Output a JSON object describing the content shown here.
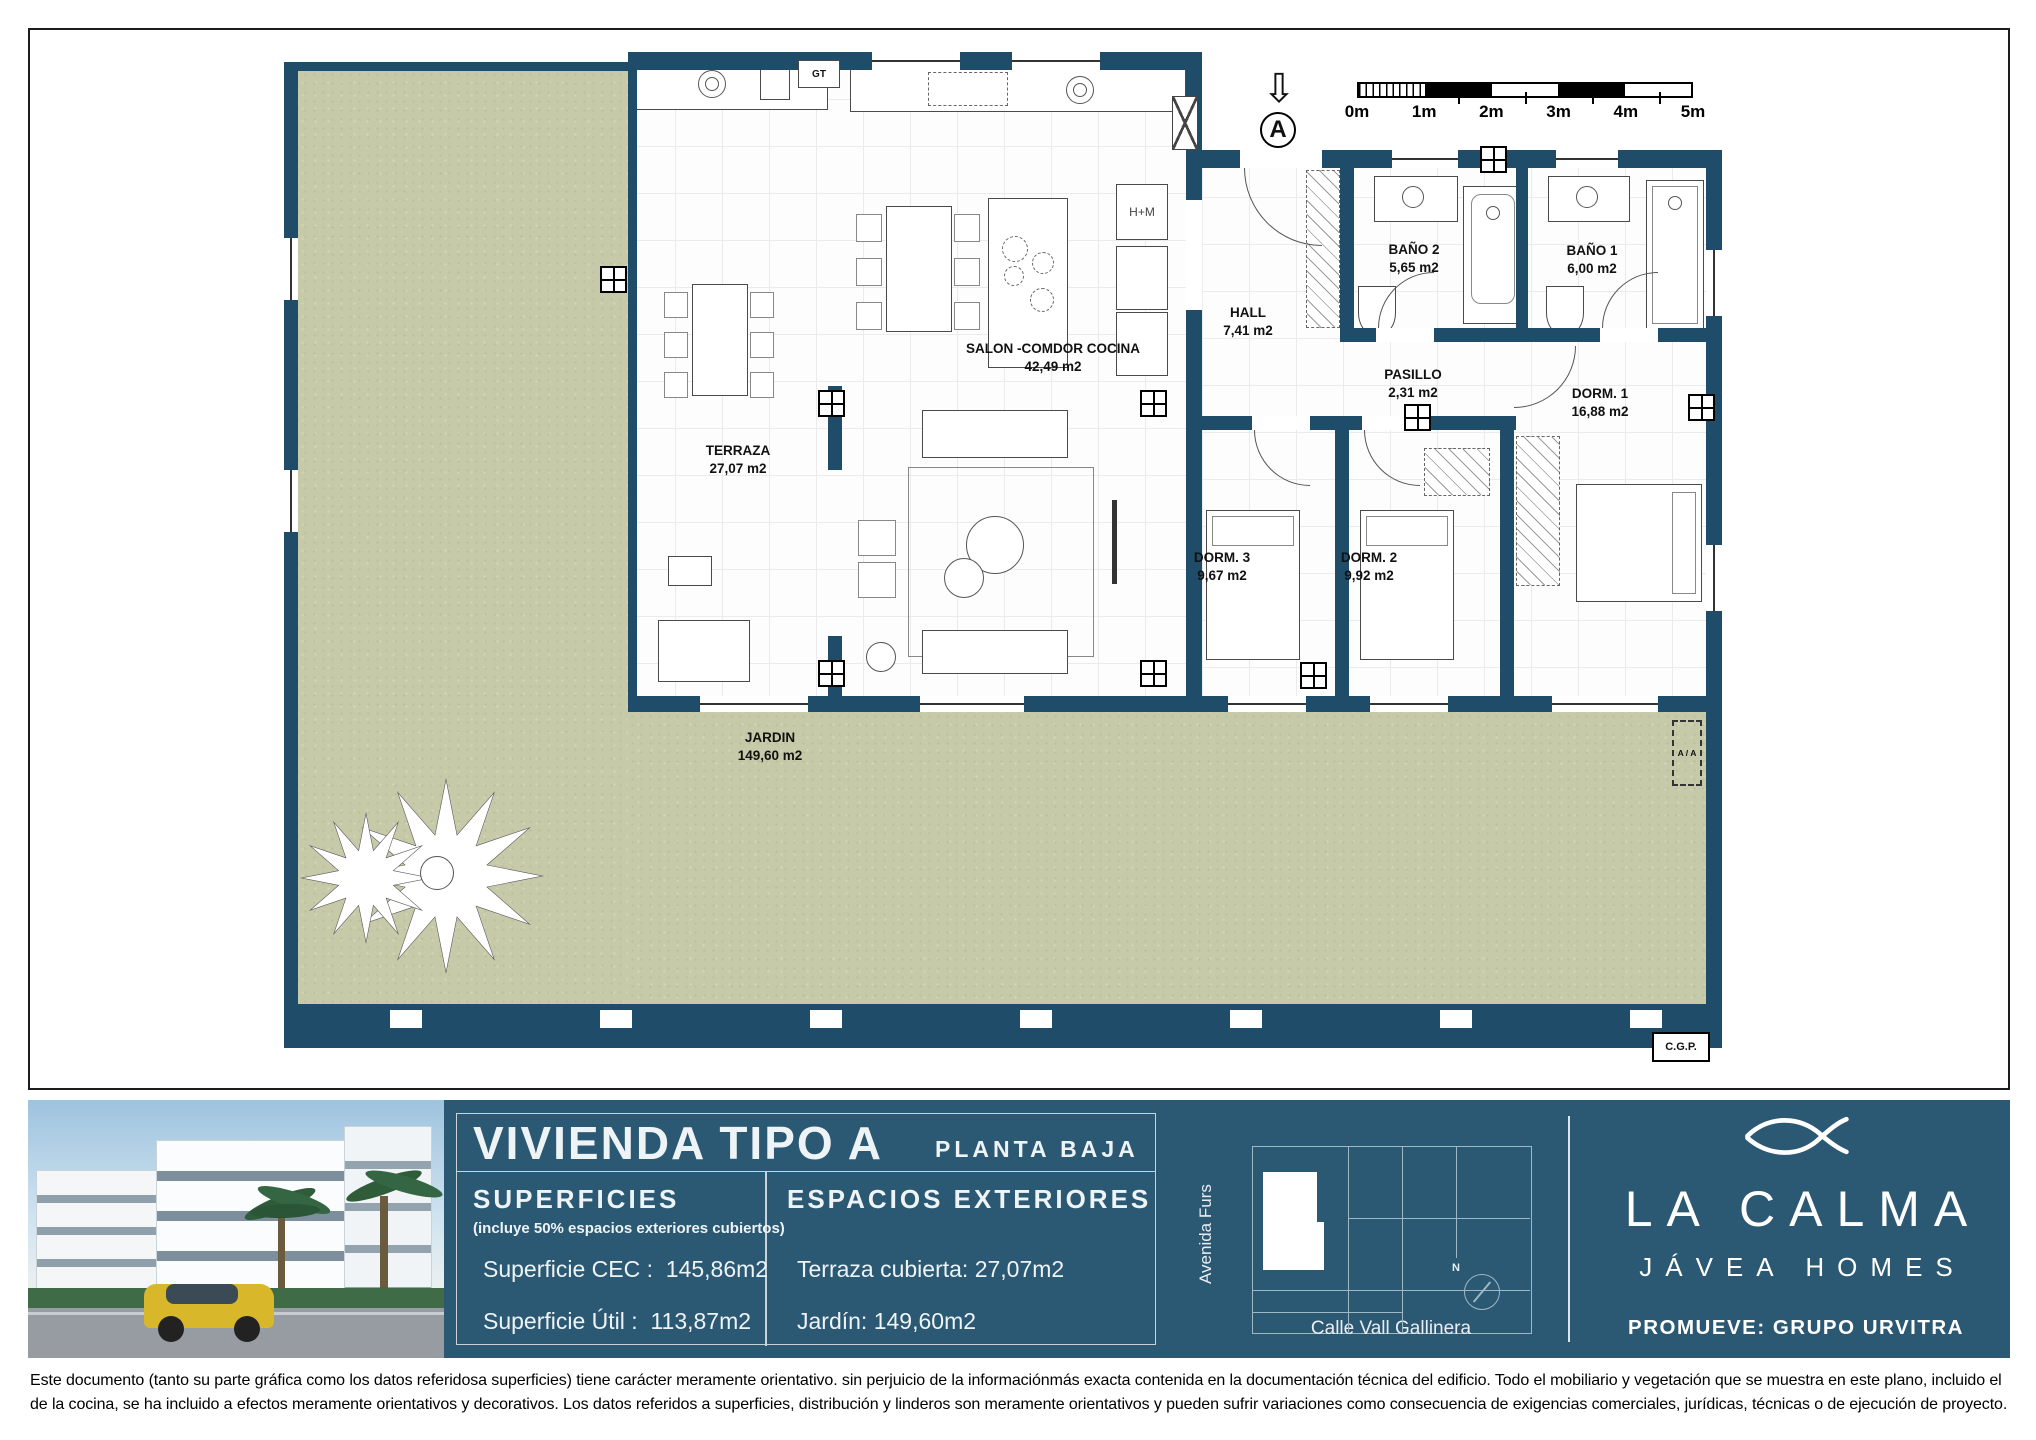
{
  "plan": {
    "rooms": {
      "terraza": {
        "name": "TERRAZA",
        "area": "27,07 m2"
      },
      "salon": {
        "name": "SALON -COMDOR COCINA",
        "area": "42,49 m2"
      },
      "hall": {
        "name": "HALL",
        "area": "7,41 m2"
      },
      "bano2": {
        "name": "BAÑO 2",
        "area": "5,65 m2"
      },
      "bano1": {
        "name": "BAÑO 1",
        "area": "6,00 m2"
      },
      "pasillo": {
        "name": "PASILLO",
        "area": "2,31 m2"
      },
      "dorm1": {
        "name": "DORM. 1",
        "area": "16,88 m2"
      },
      "dorm2": {
        "name": "DORM. 2",
        "area": "9,92 m2"
      },
      "dorm3": {
        "name": "DORM. 3",
        "area": "9,67 m2"
      },
      "jardin": {
        "name": "JARDIN",
        "area": "149,60 m2"
      }
    },
    "annotations": {
      "hm": "H+M",
      "gt": "GT",
      "aa": "A / A",
      "cgp": "C.G.P.",
      "section_letter": "A"
    },
    "scale": {
      "labels": [
        "0m",
        "1m",
        "2m",
        "3m",
        "4m",
        "5m"
      ]
    }
  },
  "panel": {
    "title": "VIVIENDA TIPO A",
    "subtitle": "PLANTA BAJA",
    "superficies": {
      "heading": "SUPERFICIES",
      "note": "(incluye 50% espacios exteriores cubiertos)",
      "rows": [
        {
          "label": "Superficie CEC :",
          "value": "145,86m2"
        },
        {
          "label": "Superficie Útil :",
          "value": "113,87m2"
        }
      ]
    },
    "exteriores": {
      "heading": "ESPACIOS EXTERIORES",
      "rows": [
        {
          "label": "Terraza cubierta:",
          "value": "27,07m2"
        },
        {
          "label": "Jardín:",
          "value": "149,60m2"
        }
      ]
    }
  },
  "map": {
    "street_left": "Avenida Furs",
    "street_bottom": "Calle Vall Gallinera",
    "compass": "N"
  },
  "brand": {
    "name": "LA CALMA",
    "tagline": "JÁVEA HOMES",
    "promoter": "PROMUEVE: GRUPO URVITRA"
  },
  "disclaimer": {
    "line1": "Este documento (tanto su parte gráfica como los datos referidosa superficies) tiene carácter meramente orientativo. sin perjuicio de la informaciónmás exacta contenida en la documentación técnica del edificio. Todo el mobiliario y vegetación que se muestra en este plano, incluido el",
    "line2": "de la cocina, se ha incluido a efectos meramente orientativos y decorativos. Los datos referidos a superficies, distribución y linderos son meramente orientativos y pueden sufrir variaciones como consecuencia de exigencias comerciales, jurídicas, técnicas o de ejecución de proyecto."
  },
  "colors": {
    "wall": "#1f4c69",
    "band": "#2b5872",
    "garden": "#c7caa9"
  }
}
